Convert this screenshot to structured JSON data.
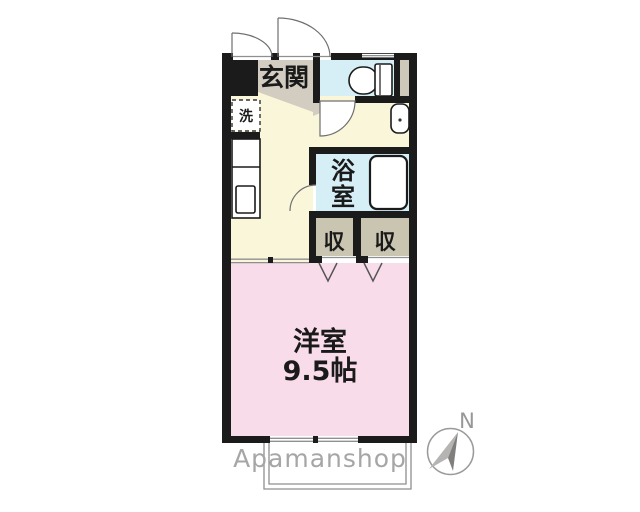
{
  "floorplan": {
    "watermark": "Apamanshop",
    "watermark_color": "#a6a6a6",
    "wall_color": "#1b1b1b",
    "compass": {
      "north_label": "N"
    },
    "rooms": {
      "genkan": {
        "label": "玄関",
        "color": "#D3CDC1"
      },
      "toilet": {
        "color": "#D6EEF6"
      },
      "pipe_shaft": {
        "color": "#CEC8BB"
      },
      "kitchen_hall": {
        "color": "#FAF6DA"
      },
      "washroom": {
        "color": "#FAF6DA"
      },
      "bathroom": {
        "label": "浴室",
        "chars": [
          "浴",
          "室"
        ],
        "color": "#D6EEF6"
      },
      "closet_left": {
        "label": "収",
        "color": "#CAC5B1"
      },
      "closet_right": {
        "label": "収",
        "color": "#CAC5B1"
      },
      "western_room": {
        "label": "洋室",
        "size": "9.5帖",
        "color": "#F8DCE9"
      }
    },
    "fixtures": {
      "laundry": {
        "label": "洗"
      }
    }
  }
}
